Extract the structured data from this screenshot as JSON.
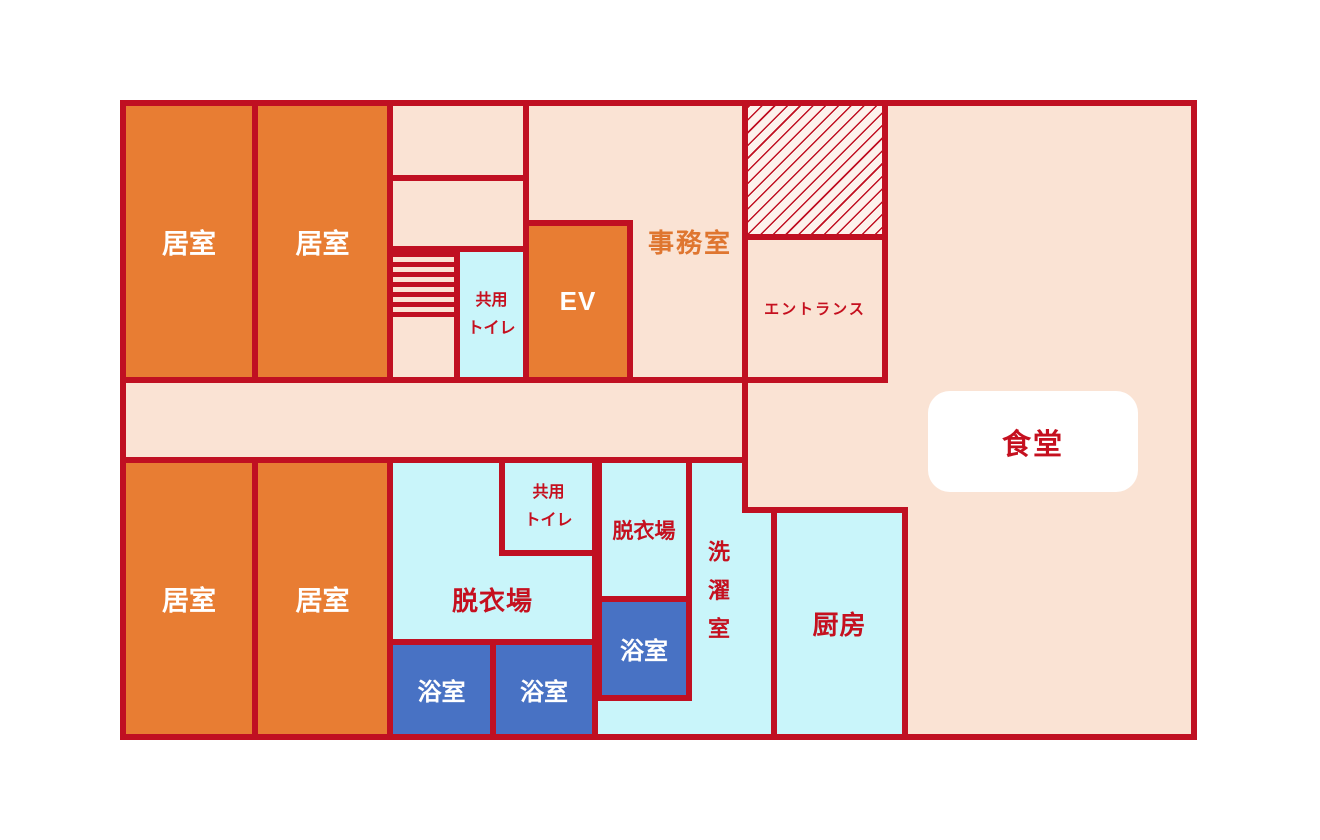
{
  "colors": {
    "wall_red": "#c01022",
    "room_orange": "#e87d33",
    "floor_peach": "#fae3d4",
    "wet_cyan": "#c9f5fa",
    "bath_blue": "#4872c4",
    "label_red": "#c5101f",
    "label_orange": "#df7630",
    "label_white": "#ffffff",
    "hatch_bg": "#fdf2ec"
  },
  "rooms": {
    "living_room_1": {
      "label": "居室"
    },
    "living_room_2": {
      "label": "居室"
    },
    "living_room_3": {
      "label": "居室"
    },
    "living_room_4": {
      "label": "居室"
    },
    "shared_toilet_upper": {
      "line1": "共用",
      "line2": "トイレ"
    },
    "elevator": {
      "label": "EV"
    },
    "office": {
      "label": "事務室"
    },
    "entrance": {
      "label": "エントランス"
    },
    "dining": {
      "label": "食堂"
    },
    "changing_room_large": {
      "label": "脱衣場"
    },
    "shared_toilet_lower": {
      "line1": "共用",
      "line2": "トイレ"
    },
    "changing_room_small": {
      "label": "脱衣場"
    },
    "bath_1": {
      "label": "浴室"
    },
    "bath_2": {
      "label": "浴室"
    },
    "bath_3": {
      "label": "浴室"
    },
    "laundry": {
      "label": "洗濯室"
    },
    "kitchen": {
      "label": "厨房"
    }
  }
}
